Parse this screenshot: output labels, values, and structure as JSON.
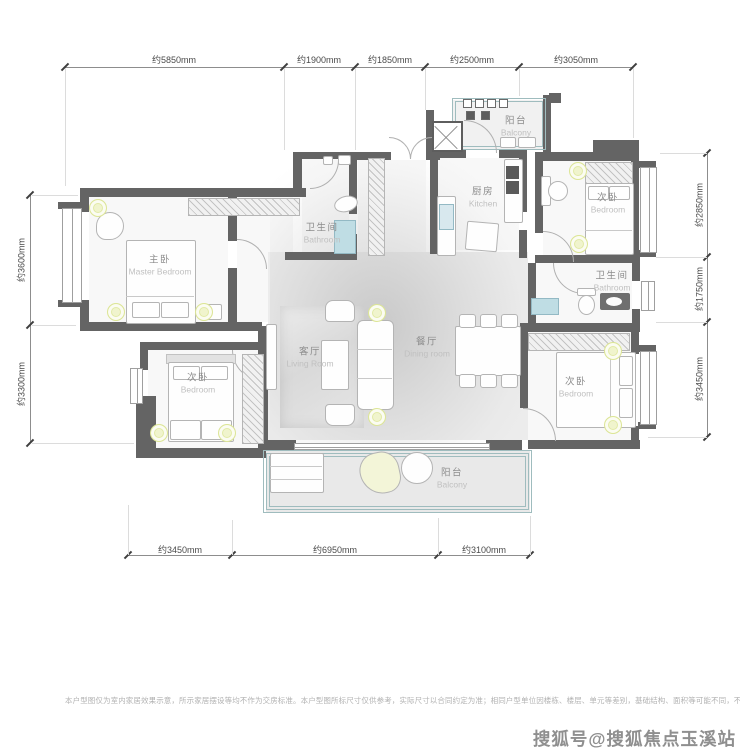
{
  "rooms": {
    "master": {
      "zh": "主卧",
      "en": "Master Bedroom"
    },
    "bath1": {
      "zh": "卫生间",
      "en": "Bathroom"
    },
    "kitchen": {
      "zh": "厨房",
      "en": "Kitchen"
    },
    "balcony_top": {
      "zh": "阳台",
      "en": "Balcony"
    },
    "bedroom_tr": {
      "zh": "次卧",
      "en": "Bedroom"
    },
    "bath2": {
      "zh": "卫生间",
      "en": "Bathroom"
    },
    "bedroom_br": {
      "zh": "次卧",
      "en": "Bedroom"
    },
    "bedroom_bl": {
      "zh": "次卧",
      "en": "Bedroom"
    },
    "living": {
      "zh": "客厅",
      "en": "Living Room"
    },
    "dining": {
      "zh": "餐厅",
      "en": "Dining room"
    },
    "balcony_bottom": {
      "zh": "阳台",
      "en": "Balcony"
    }
  },
  "dims": {
    "top": [
      "约5850mm",
      "约1900mm",
      "约1850mm",
      "约2500mm",
      "约3050mm"
    ],
    "left": [
      "约3600mm",
      "约3300mm"
    ],
    "right": [
      "约2850mm",
      "约1750mm",
      "约3450mm"
    ],
    "bottom": [
      "约3450mm",
      "约6950mm",
      "约3100mm"
    ]
  },
  "footer": {
    "disclaimer": "本户型图仅为室内家居效果示意，所示家居摆设等均不作为交房标准。本户型图所标尺寸仅供参考，实际尺寸以合同约定为准；相同户型单位因楼栋、楼层、单元等差别，基础结构、面积等可能不同，不作为交房标准或合同附件。",
    "watermark": "搜狐号@搜狐焦点玉溪站"
  },
  "colors": {
    "wall": "#646464",
    "water": "#bfdde4",
    "railing": "#9fbcbe",
    "light_fixture": "#f0f4cd",
    "label_zh": "#8c8c8c",
    "label_en": "#c0c0c0",
    "dim_text": "#4a4a4a"
  }
}
